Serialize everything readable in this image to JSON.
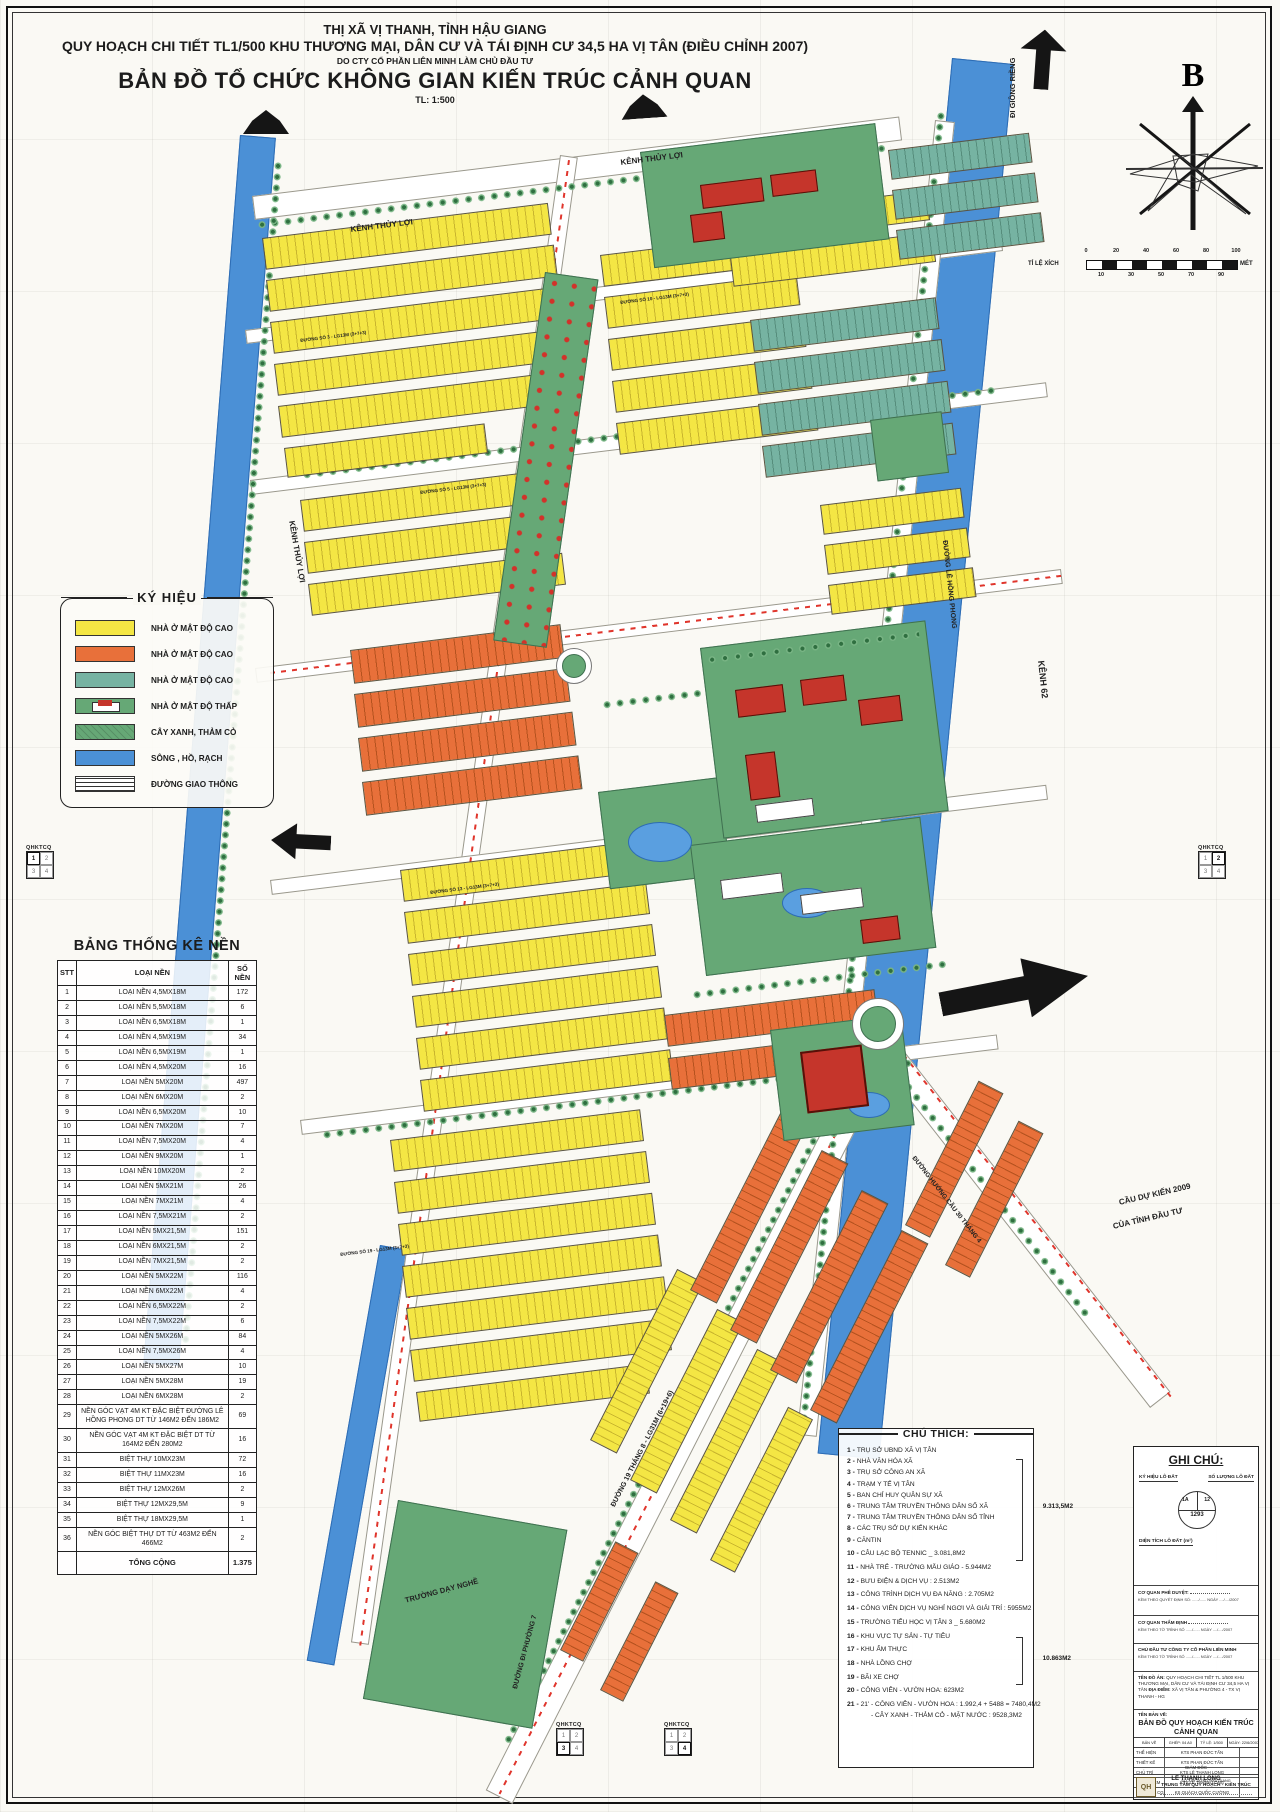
{
  "header": {
    "line1": "THỊ XÃ VỊ THANH, TỈNH HẬU GIANG",
    "line2": "QUY HOẠCH CHI TIẾT TL1/500 KHU THƯƠNG MẠI, DÂN CƯ VÀ TÁI ĐỊNH CƯ 34,5 HA VỊ TÂN (ĐIỀU CHỈNH 2007)",
    "line3": "DO CTY CỔ PHẦN LIÊN MINH LÀM CHỦ ĐẦU TƯ",
    "line4": "BẢN ĐỒ TỔ CHỨC KHÔNG GIAN KIẾN TRÚC CẢNH QUAN",
    "line5": "TL: 1:500"
  },
  "compass": {
    "north_label": "B"
  },
  "scalebar": {
    "label": "TỈ LỆ XÍCH",
    "unit": "MÉT",
    "ticks_top": [
      "0",
      "20",
      "40",
      "60",
      "80",
      "100"
    ],
    "ticks_bottom": [
      "10",
      "30",
      "50",
      "70",
      "90"
    ]
  },
  "legend": {
    "title": "KÝ HIỆU",
    "items": [
      {
        "swatch": "sw-yellow",
        "label": "NHÀ Ở MẬT ĐỘ CAO"
      },
      {
        "swatch": "sw-orange",
        "label": "NHÀ Ở MẬT ĐỘ CAO"
      },
      {
        "swatch": "sw-teal",
        "label": "NHÀ Ở MẬT ĐỘ CAO"
      },
      {
        "swatch": "sw-house",
        "label": "NHÀ Ở MẬT ĐỘ THẤP"
      },
      {
        "swatch": "sw-green",
        "label": "CÂY XANH, THẢM CỎ"
      },
      {
        "swatch": "sw-water",
        "label": "SÔNG , HỒ, RẠCH"
      },
      {
        "swatch": "sw-road",
        "label": "ĐƯỜNG GIAO THÔNG"
      }
    ]
  },
  "stats_table": {
    "title": "BẢNG THỐNG KÊ NỀN",
    "columns": [
      "STT",
      "LOẠI NỀN",
      "SỐ NỀN"
    ],
    "rows": [
      [
        "1",
        "LOẠI NỀN 4,5MX18M",
        "172"
      ],
      [
        "2",
        "LOẠI NỀN 5,5MX18M",
        "6"
      ],
      [
        "3",
        "LOẠI NỀN 6,5MX18M",
        "1"
      ],
      [
        "4",
        "LOẠI NỀN 4,5MX19M",
        "34"
      ],
      [
        "5",
        "LOẠI NỀN 6,5MX19M",
        "1"
      ],
      [
        "6",
        "LOẠI NỀN 4,5MX20M",
        "16"
      ],
      [
        "7",
        "LOẠI NỀN 5MX20M",
        "497"
      ],
      [
        "8",
        "LOẠI NỀN 6MX20M",
        "2"
      ],
      [
        "9",
        "LOẠI NỀN 6,5MX20M",
        "10"
      ],
      [
        "10",
        "LOẠI NỀN 7MX20M",
        "7"
      ],
      [
        "11",
        "LOẠI NỀN 7,5MX20M",
        "4"
      ],
      [
        "12",
        "LOẠI NỀN 9MX20M",
        "1"
      ],
      [
        "13",
        "LOẠI NỀN 10MX20M",
        "2"
      ],
      [
        "14",
        "LOẠI NỀN 5MX21M",
        "26"
      ],
      [
        "15",
        "LOẠI NỀN 7MX21M",
        "4"
      ],
      [
        "16",
        "LOẠI NỀN 7,5MX21M",
        "2"
      ],
      [
        "17",
        "LOẠI NỀN 5MX21,5M",
        "151"
      ],
      [
        "18",
        "LOẠI NỀN 6MX21,5M",
        "2"
      ],
      [
        "19",
        "LOẠI NỀN 7MX21,5M",
        "2"
      ],
      [
        "20",
        "LOẠI NỀN 5MX22M",
        "116"
      ],
      [
        "21",
        "LOẠI NỀN 6MX22M",
        "4"
      ],
      [
        "22",
        "LOẠI NỀN 6,5MX22M",
        "2"
      ],
      [
        "23",
        "LOẠI NỀN 7,5MX22M",
        "6"
      ],
      [
        "24",
        "LOẠI NỀN 5MX26M",
        "84"
      ],
      [
        "25",
        "LOẠI NỀN 7,5MX26M",
        "4"
      ],
      [
        "26",
        "LOẠI NỀN 5MX27M",
        "10"
      ],
      [
        "27",
        "LOẠI NỀN 5MX28M",
        "19"
      ],
      [
        "28",
        "LOẠI NỀN 6MX28M",
        "2"
      ],
      [
        "29",
        "NỀN GÓC VẠT 4M KT ĐẶC BIỆT ĐƯỜNG LÊ HỒNG PHONG DT TỪ 146M2 ĐẾN 186M2",
        "69"
      ],
      [
        "30",
        "NỀN GÓC VẠT 4M KT ĐẶC BIỆT DT TỪ 164M2 ĐẾN 280M2",
        "16"
      ],
      [
        "31",
        "BIỆT THỰ 10MX23M",
        "72"
      ],
      [
        "32",
        "BIỆT THỰ 11MX23M",
        "16"
      ],
      [
        "33",
        "BIỆT THỰ 12MX26M",
        "2"
      ],
      [
        "34",
        "BIỆT THỰ 12MX29,5M",
        "9"
      ],
      [
        "35",
        "BIỆT THỰ 18MX29,5M",
        "1"
      ],
      [
        "36",
        "NỀN GÓC BIỆT THỰ DT TỪ 463M2 ĐẾN 466M2",
        "2"
      ]
    ],
    "total_label": "TỔNG CỘNG",
    "total_value": "1.375"
  },
  "notes": {
    "title": "CHÚ THÍCH:",
    "items": [
      {
        "n": "1",
        "t": "TRỤ SỞ UBND XÃ VỊ TÂN"
      },
      {
        "n": "2",
        "t": "NHÀ VĂN HÓA XÃ"
      },
      {
        "n": "3",
        "t": "TRỤ SỞ CÔNG AN XÃ"
      },
      {
        "n": "4",
        "t": "TRẠM Y TẾ VỊ TÂN"
      },
      {
        "n": "5",
        "t": "BAN CHỈ HUY QUÂN SỰ XÃ"
      },
      {
        "n": "6",
        "t": "TRUNG TÂM TRUYỀN THÔNG DÂN SỐ XÃ"
      },
      {
        "n": "7",
        "t": "TRUNG TÂM TRUYỀN THÔNG DÂN SỐ TỈNH"
      },
      {
        "n": "8",
        "t": "CÁC TRỤ SỞ DỰ KIẾN KHÁC"
      },
      {
        "n": "9",
        "t": "CĂNTIN"
      },
      {
        "n": "10",
        "t": "CÂU LẠC BỘ TENNIC _ 3.081,8M2"
      },
      {
        "n": "11",
        "t": "NHÀ TRẺ - TRƯỜNG MẪU GIÁO - 5.944M2"
      },
      {
        "n": "12",
        "t": "BƯU ĐIỆN & DỊCH VỤ :  2.513M2"
      },
      {
        "n": "13",
        "t": "CÔNG TRÌNH DỊCH VỤ ĐA NĂNG :  2.705M2"
      },
      {
        "n": "14",
        "t": "CÔNG VIÊN DỊCH VỤ NGHỈ NGƠI VÀ GIẢI TRÍ :  5955M2"
      },
      {
        "n": "15",
        "t": "TRƯỜNG TIỂU HỌC VỊ TÂN 3 _ 5.680M2"
      },
      {
        "n": "16",
        "t": "KHU VỰC TỰ SẢN - TỰ TIÊU"
      },
      {
        "n": "17",
        "t": "KHU ẨM THỰC"
      },
      {
        "n": "18",
        "t": "NHÀ LỒNG CHỢ"
      },
      {
        "n": "19",
        "t": "BÃI XE CHỢ"
      },
      {
        "n": "20",
        "t": "CÔNG VIÊN - VƯỜN HOA: 623M2"
      },
      {
        "n": "21",
        "t": "21' - CÔNG VIÊN - VƯỜN HOA : 1.992,4 + 5488 = 7480,4M2"
      },
      {
        "n": "",
        "t": "- CÂY XANH - THẢM CỎ - MẶT NƯỚC : 9528,3M2"
      }
    ],
    "brace1": "9.313,5M2",
    "brace2": "10.863M2"
  },
  "ghichu": {
    "title": "GHI CHÚ:",
    "label_symbol": "KÝ HIỆU LÔ ĐẤT",
    "label_count": "SỐ LƯỢNG LÔ ĐẤT",
    "label_area": "DIỆN TÍCH LÔ ĐẤT (m²)",
    "sample": {
      "left": "1A",
      "right": "12",
      "bottom": "1293"
    },
    "a1_label": "CƠ QUAN PHÊ DUYỆT:",
    "a1_sub": "KÈM THEO QUYẾT ĐỊNH SỐ: ....../...... NGÀY ..../..../2007",
    "a2_label": "CƠ QUAN THẨM ĐỊNH",
    "a2_sub": "KÈM THEO TỜ TRÌNH SỐ ....../...... NGÀY ..../..../2007",
    "a3_label": "CHỦ ĐẦU TƯ CÔNG TY CỔ PHẦN LIÊN MINH",
    "a3_sub": "KÈM THEO TỜ TRÌNH SỐ ....../...... NGÀY ..../..../2007",
    "ten_do_an_label": "TÊN ĐỒ ÁN:",
    "ten_do_an": "QUY HOẠCH CHI TIẾT TL 1/500 KHU THƯƠNG MẠI, DÂN CƯ VÀ TÁI ĐỊNH CƯ 34,5 HA VỊ TÂN",
    "dia_diem_label": "ĐỊA ĐIỂM:",
    "dia_diem": "XÃ VỊ TÂN & PHƯỜNG 4 - TX VỊ THANH - HG",
    "ten_ban_ve_label": "TÊN BẢN VẼ:",
    "ten_ban_ve": "BẢN ĐỒ QUY HOẠCH KIẾN TRÚC CẢNH QUAN",
    "meta": [
      "BẢN VẼ",
      "GHÉP: 04 A0",
      "TỶ LỆ: 1/500",
      "NGÀY: 22/6/2007"
    ],
    "staff": [
      [
        "THỂ HIỆN",
        "KTS PHAN ĐỨC TẤN"
      ],
      [
        "THIẾT KẾ",
        "KTS PHAN ĐỨC TẤN"
      ],
      [
        "CHỦ TRÌ",
        "KTS LÊ THANH LONG"
      ],
      [
        "CHỦ NHIỆM",
        "KTS LÊ THANH LONG"
      ],
      [
        "KIỂM TRA CGP",
        "KS QUÁCH QUỐC CƯỜNG"
      ]
    ],
    "director_label": "GIÁM ĐỐC",
    "director_name": "LÊ THANH LONG",
    "org_line1": "SỞ XÂY DỰNG HẬU GIANG",
    "org_line2": "TRUNG TÂM QUY HOẠCH - KIẾN TRÚC",
    "logo_text": "QH"
  },
  "qhktcq": {
    "label": "QHKTCQ",
    "cells": [
      "1",
      "2",
      "3",
      "4"
    ]
  },
  "map": {
    "labels": {
      "kenh_thuy_loi": "KÊNH THỦY LỢI",
      "kenh62": "KÊNH 62",
      "di_giong_rieng": "ĐI GIỒNG RIỀNG",
      "le_hong_phong": "ĐƯỜNG LÊ HỒNG PHONG",
      "d19thang8": "ĐƯỜNG 19 THÁNG 8 - LG31M (6+19+6)",
      "cau30thang4": "ĐƯỜNG HƯỚNG CẦU 30 THÁNG 4",
      "di_phuong7": "ĐƯỜNG ĐI PHƯỜNG 7",
      "truong_day_nghe": "TRƯỜNG DẠY NGHỀ",
      "cau_du_kien_1": "CẦU DỰ KIẾN 2009",
      "cau_du_kien_2": "CỦA TỈNH ĐẦU TƯ"
    },
    "streets": [
      "ĐƯỜNG SỐ 3 - LG13M (3+7+3)",
      "ĐƯỜNG SỐ 5 - LG13M (3+7+3)",
      "ĐƯỜNG SỐ 10 - LG13M (3+7+3)",
      "ĐƯỜNG SỐ 13 - LG13M (3+7+3)",
      "ĐƯỜNG SỐ 19 - LG13M (3+7+3)"
    ],
    "colors": {
      "lot_yellow": "#f4e644",
      "lot_orange": "#e8703a",
      "lot_teal": "#76b3a2",
      "green": "#66a876",
      "water": "#4b90d6",
      "building_red": "#c5352b"
    }
  }
}
